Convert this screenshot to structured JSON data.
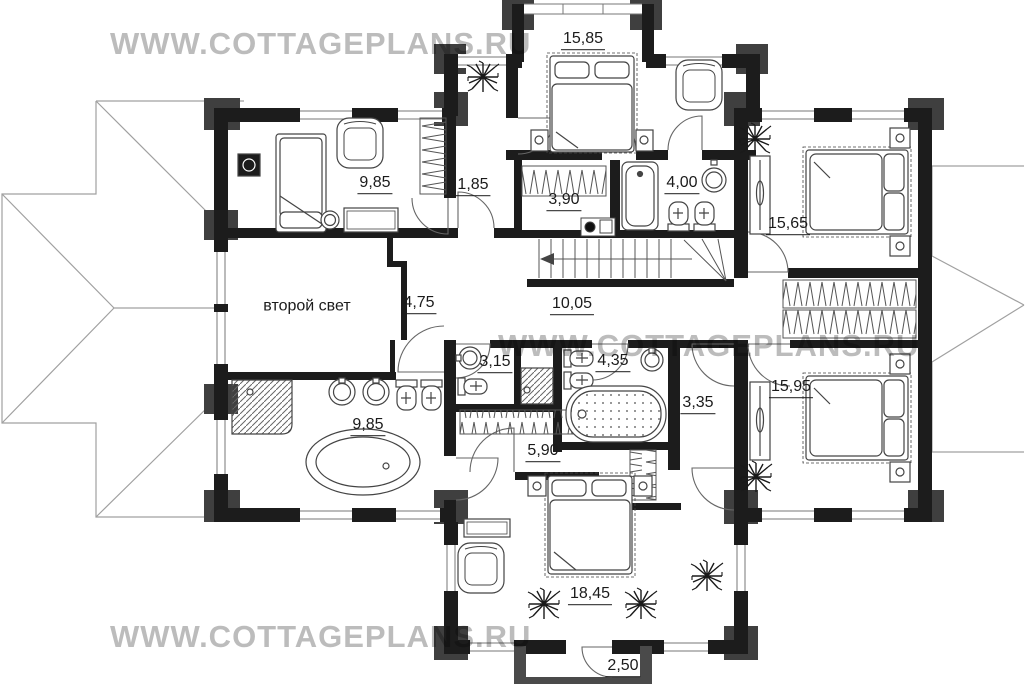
{
  "watermark": {
    "text": "WWW.COTTAGEPLANS.RU",
    "color": "#bcbcbc"
  },
  "plan": {
    "second_light_label": "второй свет",
    "rooms": [
      {
        "name": "bedroom-top-center",
        "area": "15,85"
      },
      {
        "name": "bedroom-top-left",
        "area": "9,85"
      },
      {
        "name": "hall-top",
        "area": "1,85"
      },
      {
        "name": "wardrobe-top",
        "area": "3,90"
      },
      {
        "name": "bathroom-top",
        "area": "4,00"
      },
      {
        "name": "bedroom-top-right",
        "area": "15,65"
      },
      {
        "name": "hall-west",
        "area": "4,75"
      },
      {
        "name": "corridor",
        "area": "10,05"
      },
      {
        "name": "bathroom-center-left",
        "area": "3,15"
      },
      {
        "name": "bathroom-center",
        "area": "4,35"
      },
      {
        "name": "hall-east",
        "area": "3,35"
      },
      {
        "name": "bathroom-bottom-left",
        "area": "9,85"
      },
      {
        "name": "wardrobe-bottom",
        "area": "5,90"
      },
      {
        "name": "bedroom-bottom-right",
        "area": "15,95"
      },
      {
        "name": "bedroom-bottom-center",
        "area": "18,45"
      },
      {
        "name": "balcony",
        "area": "2,50"
      }
    ]
  }
}
